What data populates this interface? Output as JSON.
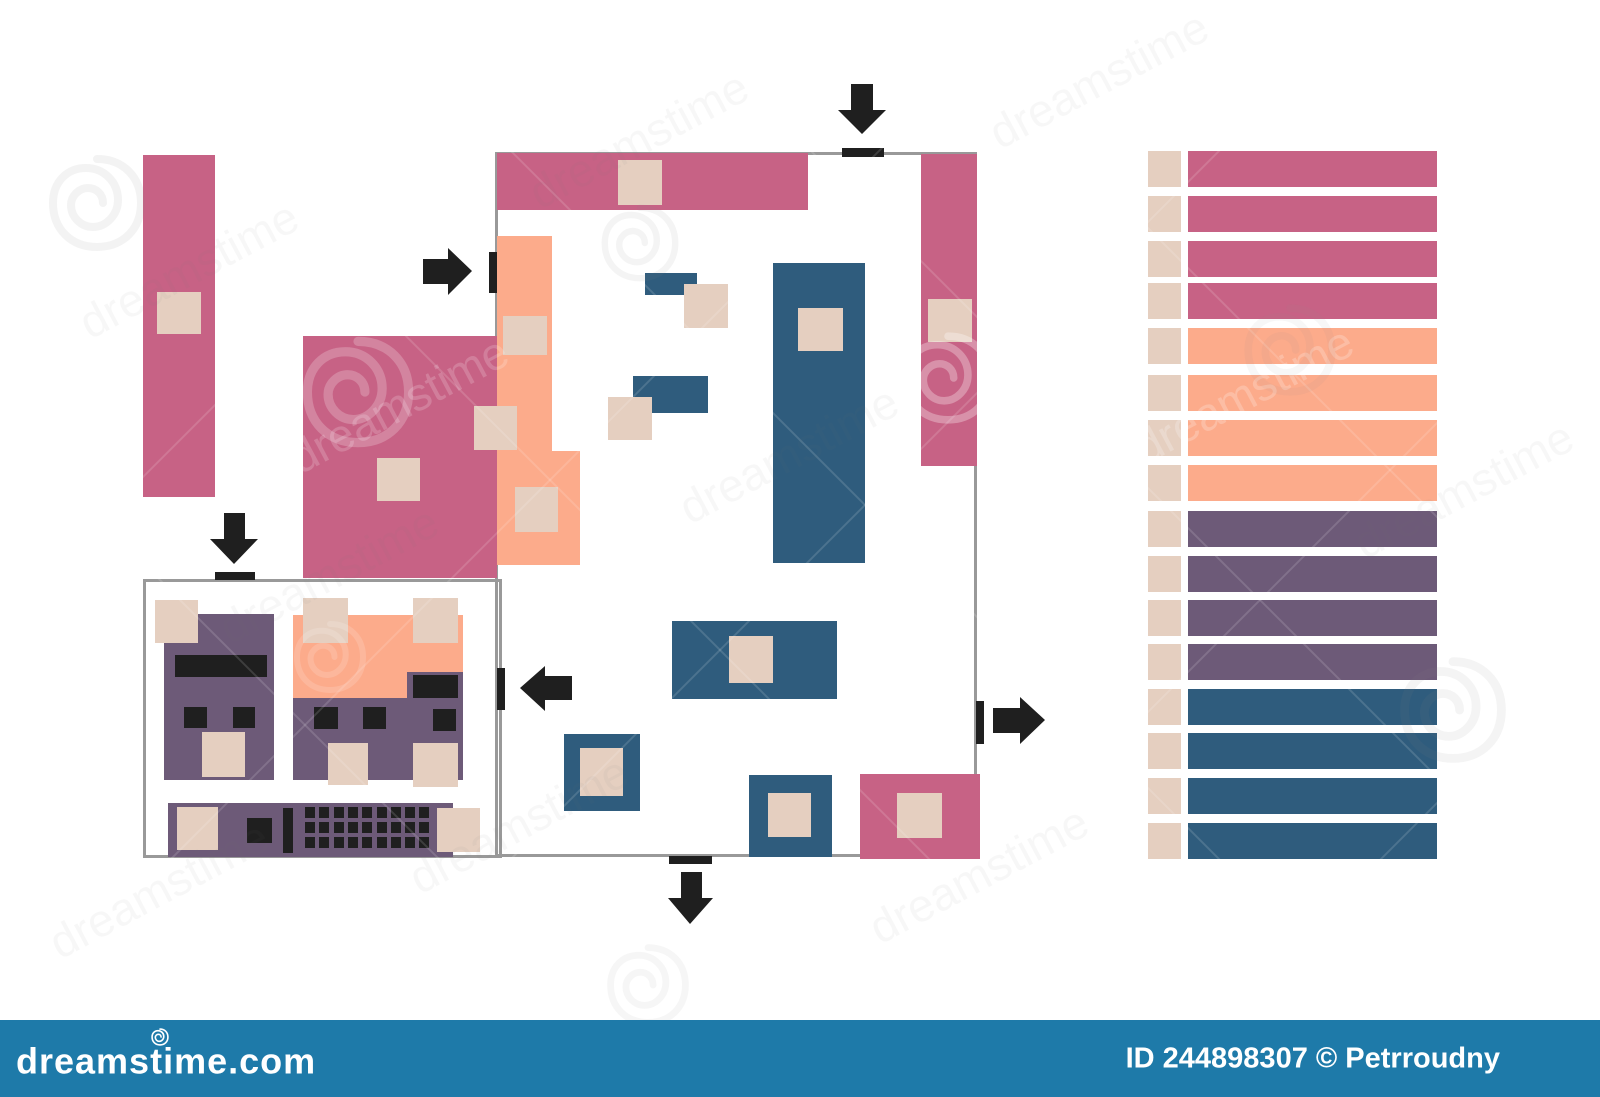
{
  "footer": {
    "logo": "dreamstime.com",
    "credit": "ID 244898307 © Petrroudny",
    "bg": "#1e7aa9"
  },
  "colors": {
    "pink": "#c76285",
    "peach": "#fcab8b",
    "blue": "#2f5c7d",
    "purple": "#6d5a78",
    "beige": "#e5cfc0",
    "wall": "#999999",
    "black": "#1f1f1f"
  },
  "plan": {
    "walls": [
      {
        "name": "wall-top",
        "x": 497,
        "y": 152,
        "w": 480,
        "h": 3
      },
      {
        "name": "wall-left",
        "x": 495,
        "y": 152,
        "w": 3,
        "h": 705
      },
      {
        "name": "wall-bottom",
        "x": 495,
        "y": 854,
        "w": 483,
        "h": 3
      },
      {
        "name": "wall-right",
        "x": 974,
        "y": 152,
        "w": 3,
        "h": 705
      }
    ],
    "inset_box": {
      "name": "checkout-area-outline",
      "x": 143,
      "y": 579,
      "w": 359,
      "h": 279
    },
    "shapes": [
      {
        "name": "shelf-pink-left",
        "color": "pink",
        "x": 143,
        "y": 155,
        "w": 72,
        "h": 342
      },
      {
        "name": "dept-pink-square",
        "color": "pink",
        "x": 303,
        "y": 336,
        "w": 194,
        "h": 242
      },
      {
        "name": "shelf-pink-top",
        "color": "pink",
        "x": 497,
        "y": 153,
        "w": 311,
        "h": 57
      },
      {
        "name": "shelf-pink-right",
        "color": "pink",
        "x": 921,
        "y": 154,
        "w": 56,
        "h": 312
      },
      {
        "name": "shelf-pink-bottom-right",
        "color": "pink",
        "x": 860,
        "y": 774,
        "w": 120,
        "h": 85
      },
      {
        "name": "shelf-peach-strip",
        "color": "peach",
        "x": 497,
        "y": 236,
        "w": 55,
        "h": 215
      },
      {
        "name": "shelf-peach-wide",
        "color": "peach",
        "x": 497,
        "y": 451,
        "w": 83,
        "h": 114
      },
      {
        "name": "shelf-blue-tall",
        "color": "blue",
        "x": 773,
        "y": 263,
        "w": 92,
        "h": 300
      },
      {
        "name": "shelf-blue-small-upper",
        "color": "blue",
        "x": 645,
        "y": 273,
        "w": 52,
        "h": 22
      },
      {
        "name": "shelf-blue-small-lower",
        "color": "blue",
        "x": 633,
        "y": 376,
        "w": 75,
        "h": 37
      },
      {
        "name": "shelf-blue-wide",
        "color": "blue",
        "x": 672,
        "y": 621,
        "w": 165,
        "h": 78
      },
      {
        "name": "island-blue-left",
        "color": "blue",
        "x": 564,
        "y": 734,
        "w": 76,
        "h": 77
      },
      {
        "name": "island-blue-right",
        "color": "blue",
        "x": 749,
        "y": 775,
        "w": 83,
        "h": 82
      },
      {
        "name": "checkout-left-body",
        "color": "purple",
        "x": 164,
        "y": 614,
        "w": 110,
        "h": 166
      },
      {
        "name": "checkout-mid-peach",
        "color": "peach",
        "x": 293,
        "y": 615,
        "w": 170,
        "h": 83
      },
      {
        "name": "checkout-mid-body",
        "color": "purple",
        "x": 293,
        "y": 698,
        "w": 114,
        "h": 82
      },
      {
        "name": "checkout-right-body",
        "color": "purple",
        "x": 407,
        "y": 672,
        "w": 56,
        "h": 108
      },
      {
        "name": "checkout-counter",
        "color": "purple",
        "x": 168,
        "y": 803,
        "w": 285,
        "h": 54
      }
    ],
    "beige_squares": [
      {
        "name": "pallet-marker",
        "x": 157,
        "y": 292,
        "w": 44,
        "h": 42
      },
      {
        "name": "pallet-marker",
        "x": 377,
        "y": 458,
        "w": 43,
        "h": 43
      },
      {
        "name": "pallet-marker",
        "x": 618,
        "y": 160,
        "w": 44,
        "h": 45
      },
      {
        "name": "pallet-marker",
        "x": 503,
        "y": 316,
        "w": 44,
        "h": 39
      },
      {
        "name": "pallet-marker",
        "x": 474,
        "y": 406,
        "w": 43,
        "h": 44
      },
      {
        "name": "pallet-marker",
        "x": 515,
        "y": 487,
        "w": 43,
        "h": 45
      },
      {
        "name": "pallet-marker",
        "x": 928,
        "y": 299,
        "w": 44,
        "h": 43
      },
      {
        "name": "pallet-marker",
        "x": 798,
        "y": 308,
        "w": 45,
        "h": 43
      },
      {
        "name": "pallet-marker",
        "x": 684,
        "y": 284,
        "w": 44,
        "h": 44
      },
      {
        "name": "pallet-marker",
        "x": 608,
        "y": 397,
        "w": 44,
        "h": 43
      },
      {
        "name": "pallet-marker",
        "x": 729,
        "y": 636,
        "w": 44,
        "h": 47
      },
      {
        "name": "pallet-marker",
        "x": 580,
        "y": 748,
        "w": 43,
        "h": 48
      },
      {
        "name": "pallet-marker",
        "x": 768,
        "y": 793,
        "w": 43,
        "h": 44
      },
      {
        "name": "pallet-marker",
        "x": 897,
        "y": 793,
        "w": 45,
        "h": 45
      },
      {
        "name": "pallet-marker",
        "x": 155,
        "y": 600,
        "w": 43,
        "h": 43
      },
      {
        "name": "pallet-marker",
        "x": 202,
        "y": 732,
        "w": 43,
        "h": 45
      },
      {
        "name": "pallet-marker",
        "x": 303,
        "y": 598,
        "w": 45,
        "h": 45
      },
      {
        "name": "pallet-marker",
        "x": 413,
        "y": 598,
        "w": 45,
        "h": 45
      },
      {
        "name": "pallet-marker",
        "x": 328,
        "y": 743,
        "w": 40,
        "h": 42
      },
      {
        "name": "pallet-marker",
        "x": 413,
        "y": 743,
        "w": 45,
        "h": 44
      },
      {
        "name": "pallet-marker",
        "x": 177,
        "y": 807,
        "w": 41,
        "h": 43
      },
      {
        "name": "pallet-marker",
        "x": 437,
        "y": 808,
        "w": 43,
        "h": 44
      }
    ],
    "black_details": [
      {
        "name": "checkout-display-bar",
        "x": 175,
        "y": 655,
        "w": 92,
        "h": 22
      },
      {
        "name": "checkout-key",
        "x": 184,
        "y": 707,
        "w": 23,
        "h": 21
      },
      {
        "name": "checkout-key",
        "x": 233,
        "y": 707,
        "w": 22,
        "h": 21
      },
      {
        "name": "checkout-key",
        "x": 314,
        "y": 707,
        "w": 24,
        "h": 22
      },
      {
        "name": "checkout-key",
        "x": 363,
        "y": 707,
        "w": 23,
        "h": 22
      },
      {
        "name": "checkout-display-bar",
        "x": 413,
        "y": 675,
        "w": 45,
        "h": 23
      },
      {
        "name": "checkout-key",
        "x": 433,
        "y": 709,
        "w": 23,
        "h": 22
      },
      {
        "name": "checkout-key",
        "x": 247,
        "y": 818,
        "w": 25,
        "h": 25
      },
      {
        "name": "checkout-divider-bar",
        "x": 283,
        "y": 808,
        "w": 10,
        "h": 45
      }
    ],
    "keyboard": {
      "x": 305,
      "y": 807,
      "cols": 9,
      "rows": 3,
      "pitch_x": 14.3,
      "pitch_y": 15.2,
      "key_w": 10,
      "key_h": 11
    },
    "door_ticks": [
      {
        "name": "door-top",
        "x": 842,
        "y": 148,
        "w": 42,
        "h": 9
      },
      {
        "name": "door-left-upper",
        "x": 489,
        "y": 252,
        "w": 8,
        "h": 41
      },
      {
        "name": "door-checkout-top",
        "x": 215,
        "y": 572,
        "w": 40,
        "h": 8
      },
      {
        "name": "door-left-lower",
        "x": 497,
        "y": 668,
        "w": 8,
        "h": 42
      },
      {
        "name": "door-right",
        "x": 976,
        "y": 701,
        "w": 8,
        "h": 43
      },
      {
        "name": "door-bottom",
        "x": 669,
        "y": 856,
        "w": 43,
        "h": 8
      }
    ],
    "arrows": [
      {
        "name": "arrow-entrance-top",
        "points": "851,84 873,84 873,110 886,110 862,134 838,110 851,110"
      },
      {
        "name": "arrow-entrance-left",
        "points": "423,259 448,259 448,248 472,271 448,295 448,284 423,284"
      },
      {
        "name": "arrow-entrance-checkout",
        "points": "224,513 245,513 245,539 258,539 234,564 210,539 224,539"
      },
      {
        "name": "arrow-exit-left",
        "points": "572,676 572,700 545,700 545,711 520,688 545,666 545,676"
      },
      {
        "name": "arrow-exit-right",
        "points": "993,708 1020,708 1020,697 1045,720 1020,744 1020,733 993,733"
      },
      {
        "name": "arrow-exit-bottom",
        "points": "681,872 702,872 702,898 713,898 690,924 668,898 681,898"
      }
    ]
  },
  "legend": {
    "square": {
      "x": 1148,
      "w": 33,
      "h": 36
    },
    "bar": {
      "x": 1188,
      "w": 249,
      "h": 36
    },
    "rows": [
      {
        "color": "pink",
        "y": 151
      },
      {
        "color": "pink",
        "y": 196
      },
      {
        "color": "pink",
        "y": 241
      },
      {
        "color": "pink",
        "y": 283
      },
      {
        "color": "peach",
        "y": 328
      },
      {
        "color": "peach",
        "y": 375
      },
      {
        "color": "peach",
        "y": 420
      },
      {
        "color": "peach",
        "y": 465
      },
      {
        "color": "purple",
        "y": 511
      },
      {
        "color": "purple",
        "y": 556
      },
      {
        "color": "purple",
        "y": 600
      },
      {
        "color": "purple",
        "y": 644
      },
      {
        "color": "blue",
        "y": 689
      },
      {
        "color": "blue",
        "y": 733
      },
      {
        "color": "blue",
        "y": 778
      },
      {
        "color": "blue",
        "y": 823
      }
    ]
  },
  "watermark": {
    "brand": "dreamstime",
    "texts": [
      {
        "x": 90,
        "y": 340,
        "color": "#777777",
        "opacity": 0.05
      },
      {
        "x": 540,
        "y": 210,
        "color": "#777777",
        "opacity": 0.05
      },
      {
        "x": 1000,
        "y": 150,
        "color": "#777777",
        "opacity": 0.05
      },
      {
        "x": 230,
        "y": 645,
        "color": "#777777",
        "opacity": 0.05
      },
      {
        "x": 690,
        "y": 525,
        "color": "#777777",
        "opacity": 0.05
      },
      {
        "x": 1365,
        "y": 560,
        "color": "#777777",
        "opacity": 0.05
      },
      {
        "x": 420,
        "y": 895,
        "color": "#777777",
        "opacity": 0.05
      },
      {
        "x": 880,
        "y": 945,
        "color": "#777777",
        "opacity": 0.05
      },
      {
        "x": 60,
        "y": 960,
        "color": "#777777",
        "opacity": 0.05
      },
      {
        "x": 300,
        "y": 475,
        "color": "#ffffff",
        "opacity": 0.18
      },
      {
        "x": 1145,
        "y": 465,
        "color": "#ffffff",
        "opacity": 0.22
      }
    ],
    "spirals": [
      {
        "x": 358,
        "y": 392,
        "s": 1.15,
        "color": "#ffffff",
        "opacity": 0.22
      },
      {
        "x": 948,
        "y": 378,
        "s": 0.95,
        "color": "#ffffff",
        "opacity": 0.3
      },
      {
        "x": 330,
        "y": 657,
        "s": 0.75,
        "color": "#ffffff",
        "opacity": 0.15
      },
      {
        "x": 97,
        "y": 203,
        "s": 1.0,
        "color": "#888888",
        "opacity": 0.1
      },
      {
        "x": 640,
        "y": 243,
        "s": 0.8,
        "color": "#888888",
        "opacity": 0.09
      },
      {
        "x": 1453,
        "y": 710,
        "s": 1.1,
        "color": "#888888",
        "opacity": 0.09
      },
      {
        "x": 1290,
        "y": 350,
        "s": 0.95,
        "color": "#888888",
        "opacity": 0.07
      },
      {
        "x": 648,
        "y": 985,
        "s": 0.85,
        "color": "#888888",
        "opacity": 0.08
      }
    ],
    "diag_lines": [
      [
        150,
        80,
        1050,
        980
      ],
      [
        420,
        60,
        1380,
        1020
      ],
      [
        700,
        40,
        1600,
        940
      ],
      [
        60,
        480,
        600,
        1020
      ],
      [
        980,
        60,
        1600,
        680
      ],
      [
        560,
        60,
        40,
        580
      ],
      [
        950,
        80,
        150,
        880
      ],
      [
        1310,
        60,
        480,
        890
      ],
      [
        1600,
        260,
        820,
        1040
      ],
      [
        1600,
        640,
        1180,
        1060
      ]
    ]
  }
}
